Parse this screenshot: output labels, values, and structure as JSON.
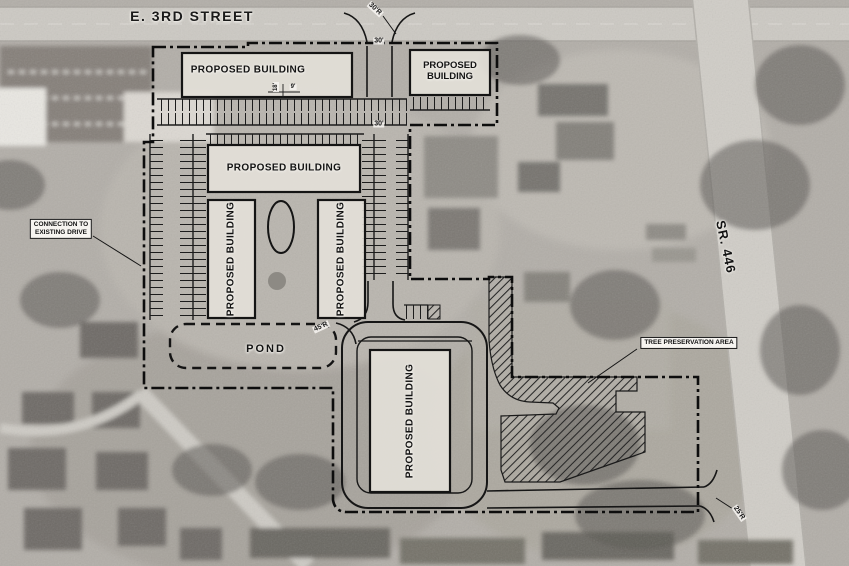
{
  "plan": {
    "streets": {
      "e3rd": "E. 3RD STREET",
      "sr446": "SR. 446"
    },
    "buildings": {
      "top": "PROPOSED BUILDING",
      "top_right_line1": "PROPOSED",
      "top_right_line2": "BUILDING",
      "mid": "PROPOSED BUILDING",
      "left_wing": "PROPOSED BUILDING",
      "right_wing": "PROPOSED BUILDING",
      "south": "PROPOSED BUILDING"
    },
    "features": {
      "pond": "POND",
      "connection_line1": "CONNECTION TO",
      "connection_line2": "EXISTING DRIVE",
      "tree_preservation": "TREE PRESERVATION AREA"
    },
    "dimensions": {
      "radius_30": "30'R",
      "width_30_north": "30'",
      "width_30_mid": "30'",
      "radius_45": "45'R",
      "radius_25": "25'R",
      "stall_depth": "18'",
      "stall_width": "9'"
    },
    "colors": {
      "linework": "#141414",
      "building_fill": "#e3dfd8",
      "label_background": "#f6f4f0"
    }
  }
}
